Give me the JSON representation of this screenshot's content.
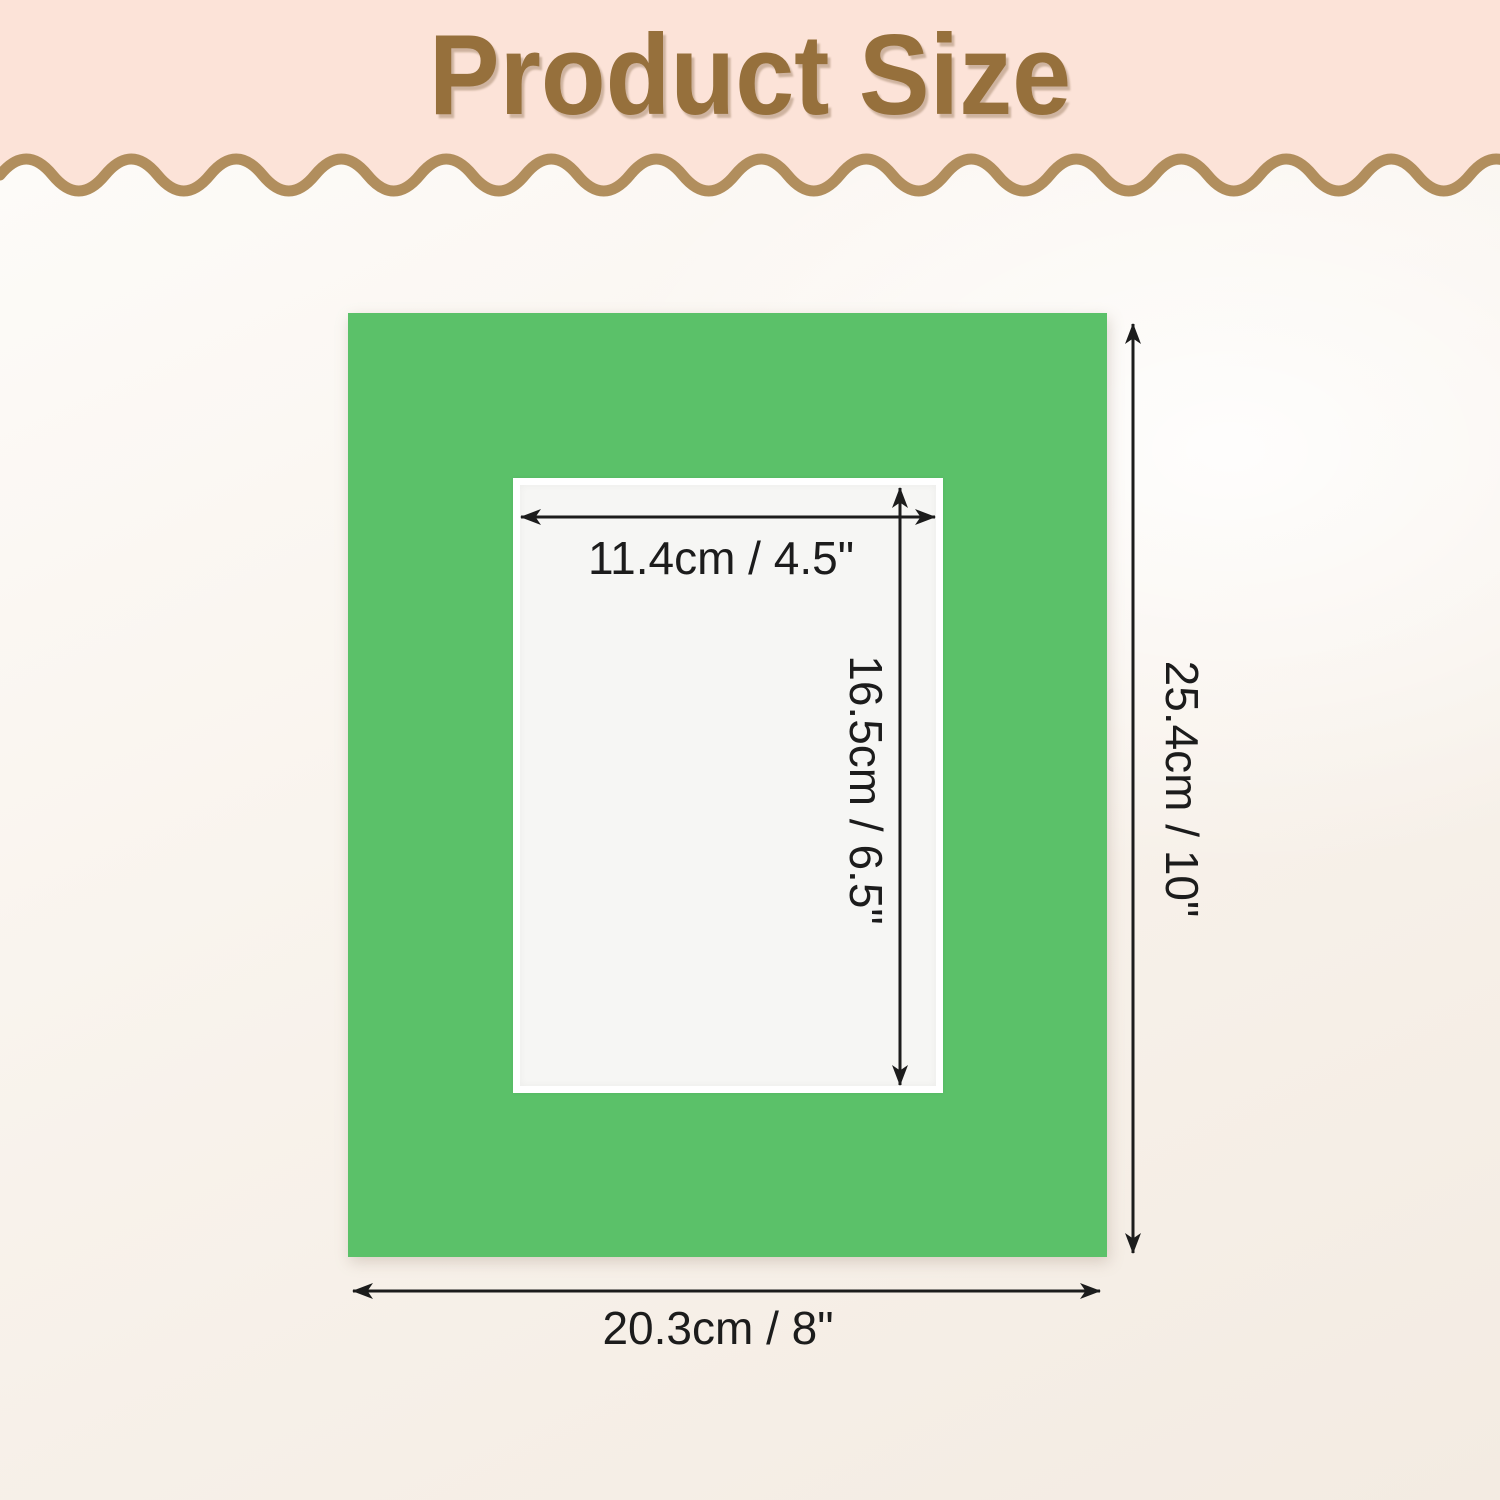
{
  "header": {
    "title": "Product Size"
  },
  "dimensions": {
    "inner_width": "11.4cm / 4.5\"",
    "inner_height": "16.5cm / 6.5\"",
    "outer_height": "25.4cm / 10\"",
    "outer_width": "20.3cm / 8\""
  },
  "colors": {
    "banner_bg": "#fce3d8",
    "title_brown": "#96703c",
    "wave_brown": "#b18e5d",
    "page_bg_light": "#fdfbf8",
    "page_bg_shade": "#f3ebe2",
    "mat_green": "#5bc169",
    "cutout_white": "#f6f6f4",
    "bevel_white": "#ffffff",
    "arrow_black": "#1c1c1c"
  }
}
